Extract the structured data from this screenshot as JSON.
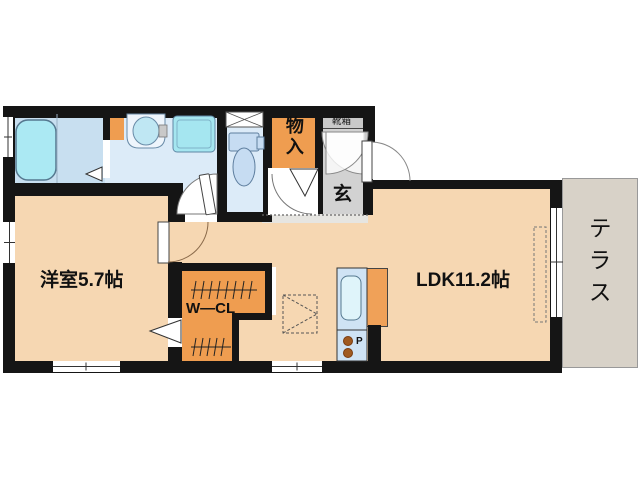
{
  "rooms": {
    "western_room": {
      "label": "洋室5.7帖"
    },
    "ldk": {
      "label": "LDK11.2帖"
    },
    "walk_in_closet": {
      "label": "W―CL"
    },
    "storage": {
      "label": "物入"
    },
    "entrance_hall": {
      "label": "玄"
    },
    "shoe_cabinet": {
      "label": "靴箱"
    },
    "terrace": {
      "label": "テラス"
    },
    "kitchen": {
      "stove_label": "P"
    }
  },
  "colors": {
    "wall": "#151515",
    "room_floor": "#f6d7b2",
    "closet_floor": "#ef9d50",
    "wet_area_floor": "#dcebf8",
    "bath_floor": "#c8dff0",
    "bathtub": "#abe9f3",
    "entrance_floor": "#d2d2d2",
    "step_strip": "#e6e5e1",
    "terrace_floor": "#d8d2c8",
    "shoe_cabinet_fill": "#c9c9c9",
    "kitchen_counter": "#cfe3f4",
    "burner": "#a05a20"
  }
}
